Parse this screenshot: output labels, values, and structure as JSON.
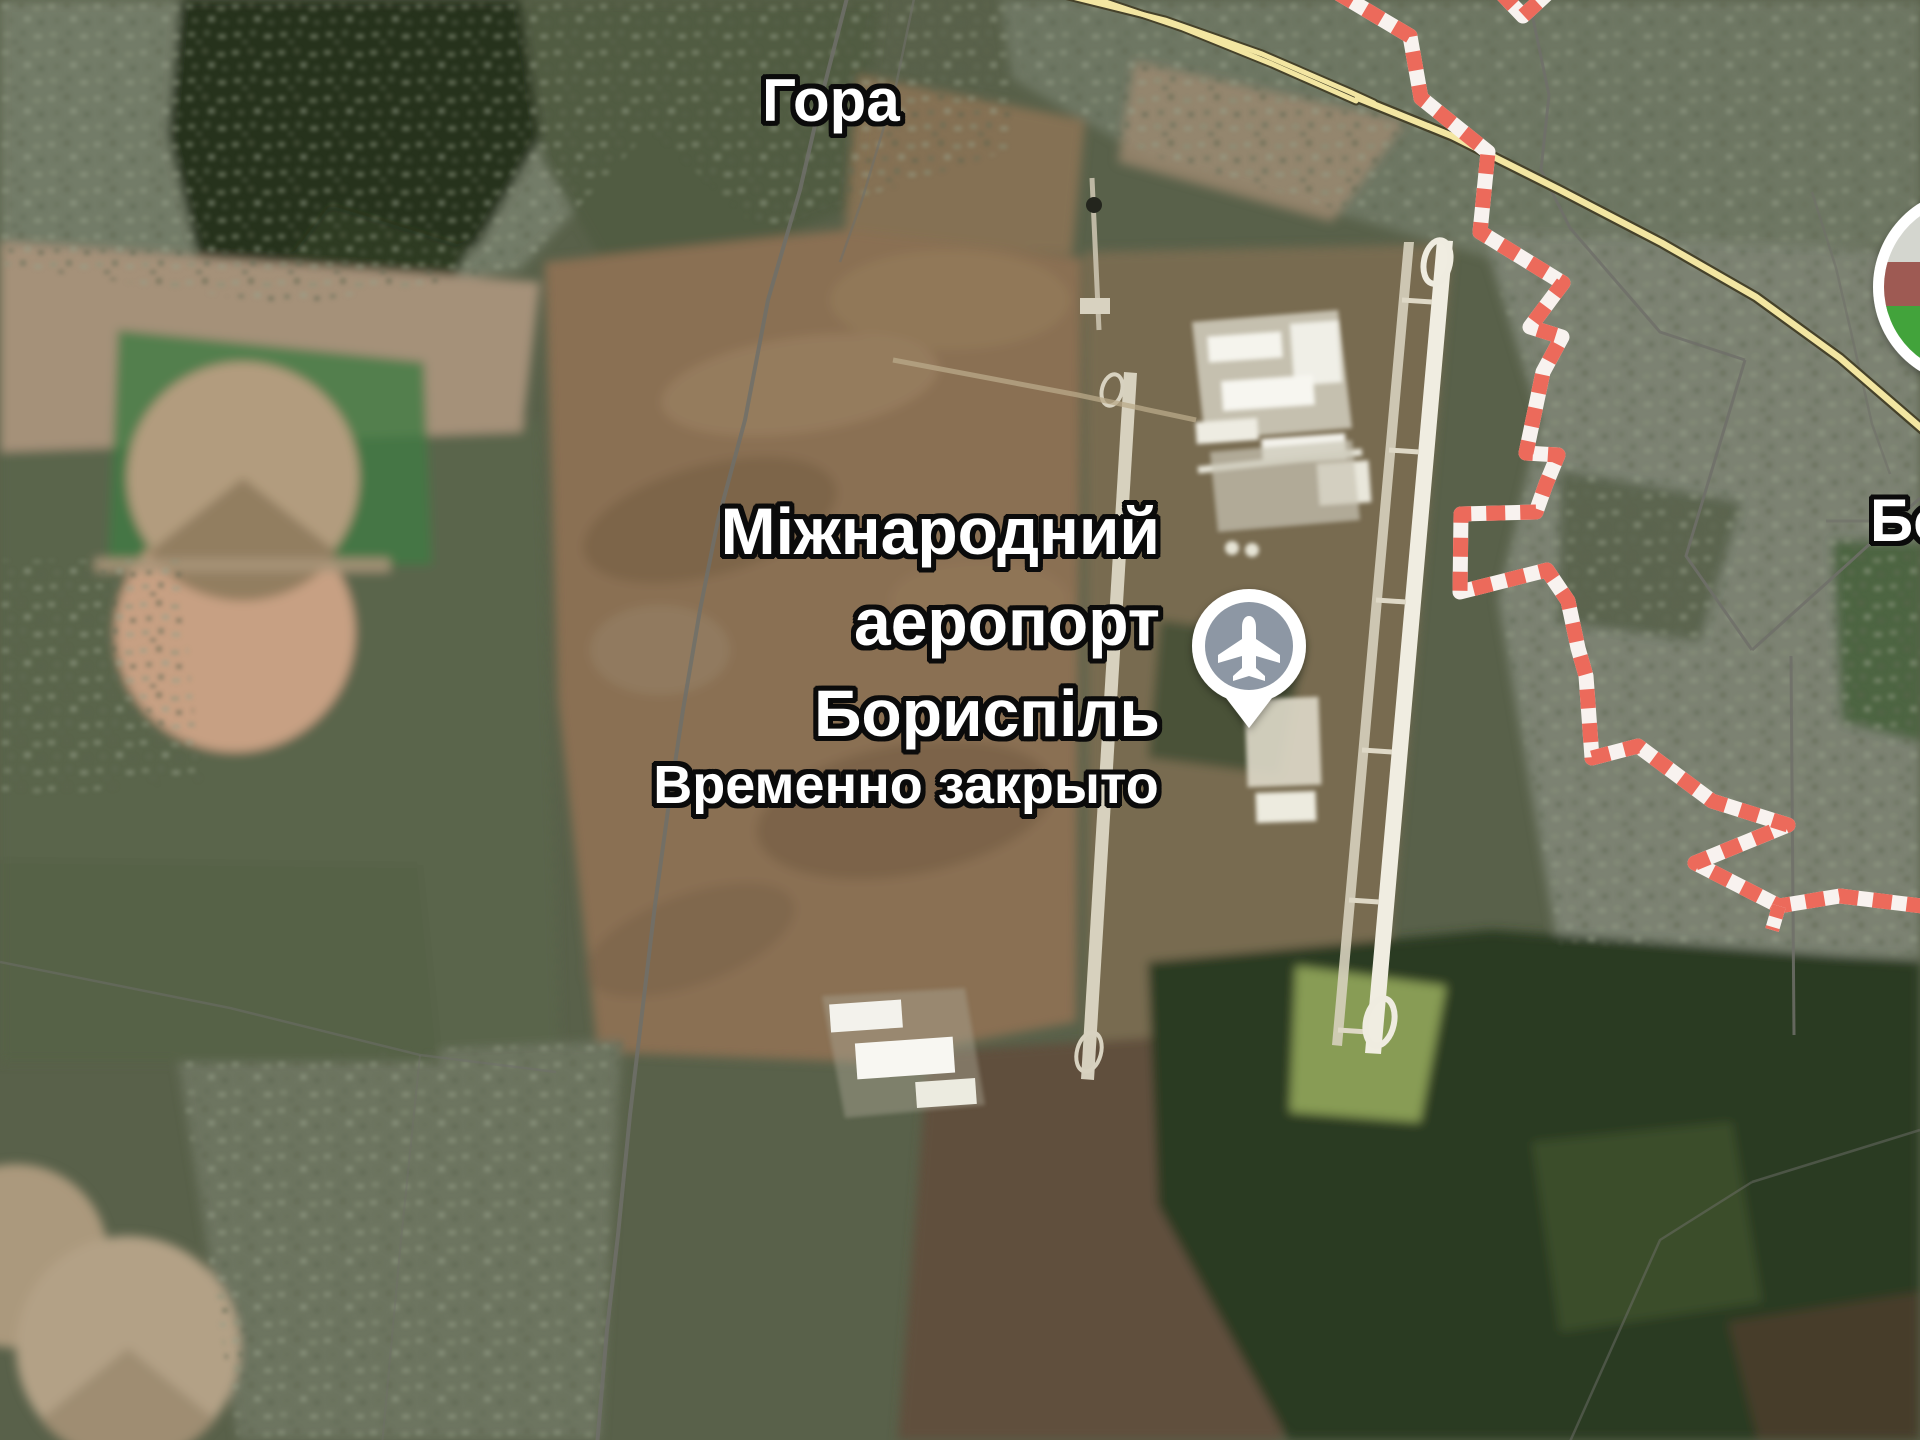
{
  "map": {
    "view_type": "satellite",
    "labels": {
      "town_top": "Гора",
      "airport": {
        "line1": "Міжнародний",
        "line2": "аеропорт",
        "line3": "Бориспіль"
      },
      "status": "Временно закрыто",
      "town_right_partial": "Бо"
    },
    "icons": {
      "airport_pin": "airplane-pin",
      "photo_circle": "place-photo-thumbnail"
    },
    "colors": {
      "boundary_red": "#EC6A5B",
      "boundary_white": "#F8F2EF",
      "road_yellow": "#F3E6A2",
      "road_casing": "#45412A",
      "admin_gray": "#70706A",
      "pin_circle": "#8D97A4",
      "label_text": "#FFFFFF",
      "label_outline": "#000000"
    }
  }
}
